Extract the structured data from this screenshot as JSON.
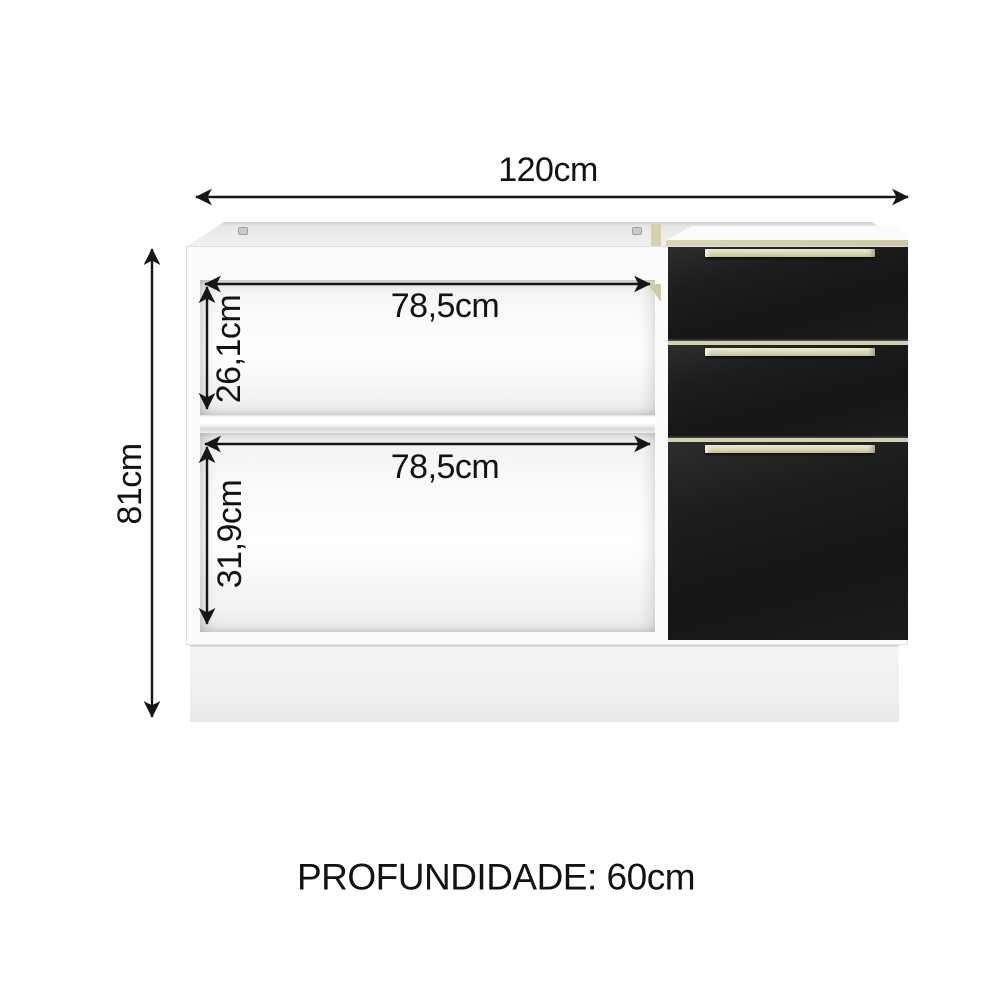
{
  "diagram": {
    "dimensions": {
      "width": "120cm",
      "height": "81cm",
      "depth": "PROFUNDIDADE: 60cm",
      "upper_compartment": {
        "width": "78,5cm",
        "height": "26,1cm"
      },
      "lower_compartment": {
        "width": "78,5cm",
        "height": "31,9cm"
      }
    },
    "cabinet": {
      "drawer_count": 3,
      "colors": {
        "body": "#fbfbfa",
        "drawer_front": "#1a1a1c",
        "handle_trim": "#d8d6b4",
        "plinth": "#f0f0ee",
        "dimension_ink": "#161616"
      }
    }
  }
}
